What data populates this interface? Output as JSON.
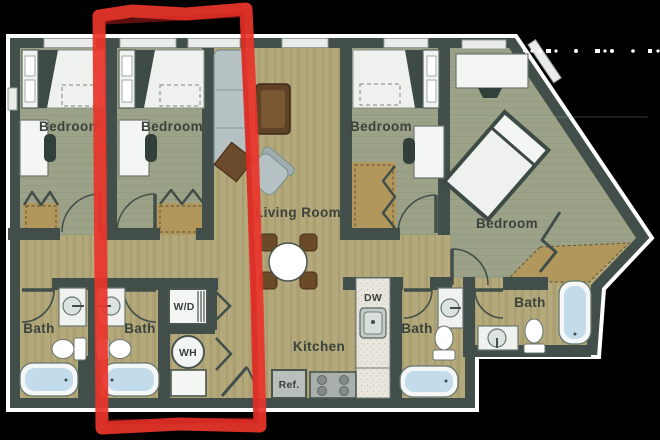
{
  "rooms": {
    "bedroom_1": "Bedroom",
    "bedroom_2": "Bedroom",
    "bedroom_3": "Bedroom",
    "bedroom_4": "Bedroom",
    "living_room": "Living Room",
    "kitchen": "Kitchen",
    "bath_1": "Bath",
    "bath_2": "Bath",
    "bath_3": "Bath",
    "bath_4": "Bath"
  },
  "fixtures": {
    "washer_dryer": "W/D",
    "water_heater": "WH",
    "refrigerator": "Ref.",
    "dishwasher": "DW"
  },
  "annotation": {
    "shape": "hand-drawn red marker rectangle highlighting second bedroom column",
    "color": "#e8352b"
  },
  "colors": {
    "background": "#000000",
    "wall": "#414e49",
    "wood_floor": "#b3a97b",
    "bedroom_floor": "#9ca287",
    "closet_tan": "#b2975c",
    "tub_water": "#c2dcec",
    "sofa": "#b5c1c2"
  }
}
